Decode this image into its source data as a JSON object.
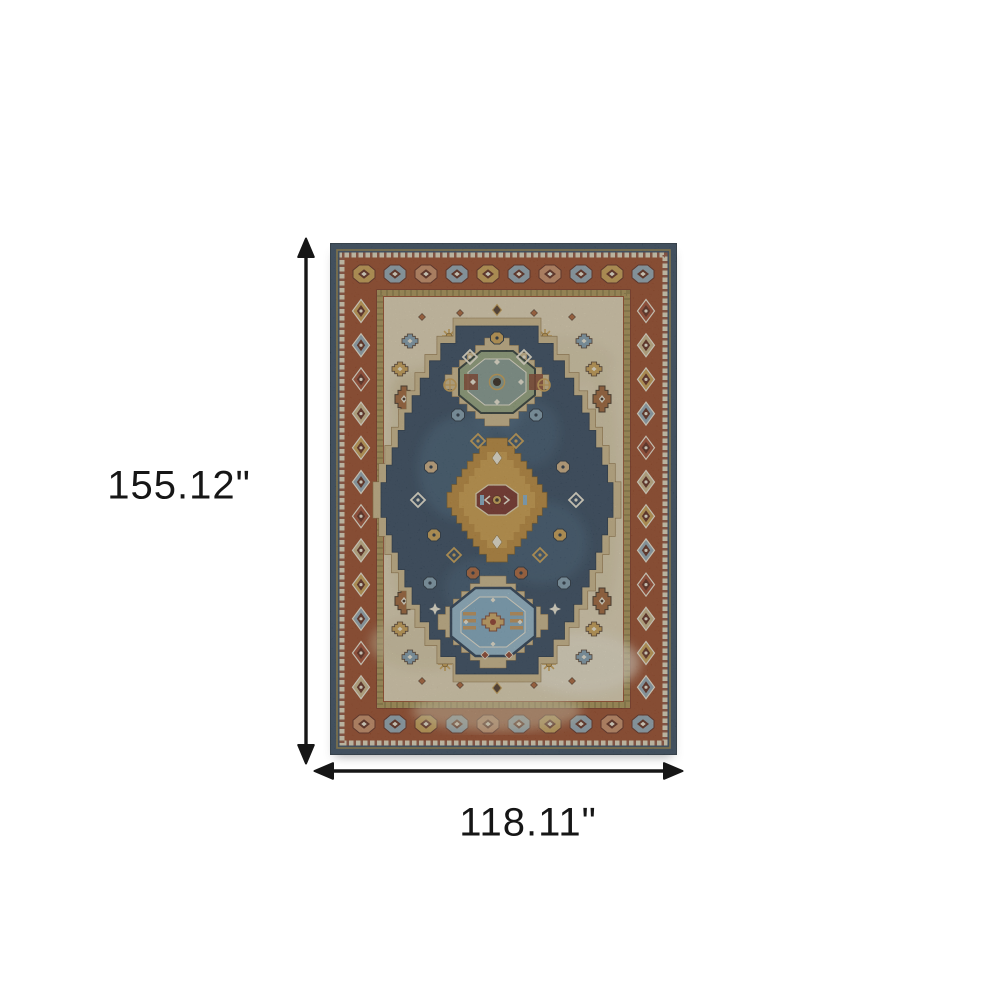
{
  "diagram": {
    "description": "Area rug product dimension diagram",
    "rug_style": "Oriental stepped-medallion area rug in blue, rust, gold and ivory"
  },
  "dimensions": {
    "height_label": "155.12\"",
    "width_label": "118.11\""
  },
  "colors": {
    "background": "#ffffff",
    "arrow": "#161616",
    "navy_edge": "#32475b",
    "navy_field": "#2c4156",
    "rust_border": "#93421f",
    "cream_field": "#dccfae",
    "olive_guard": "#a68f4c",
    "tan_halo": "#c7b183",
    "gold_medallion": "#b5812f",
    "red_core": "#72291d",
    "sage_medallion": "#8c9c74",
    "blue_medallion": "#8fb2c4",
    "ivory": "#e9e2cf",
    "accent_slate": "#8ea3ad",
    "accent_peach": "#c4875e",
    "accent_gold": "#c49a4a",
    "accent_rust": "#a65c2e",
    "accent_blue": "#7b98a8",
    "dark_outline": "#5a2414"
  }
}
